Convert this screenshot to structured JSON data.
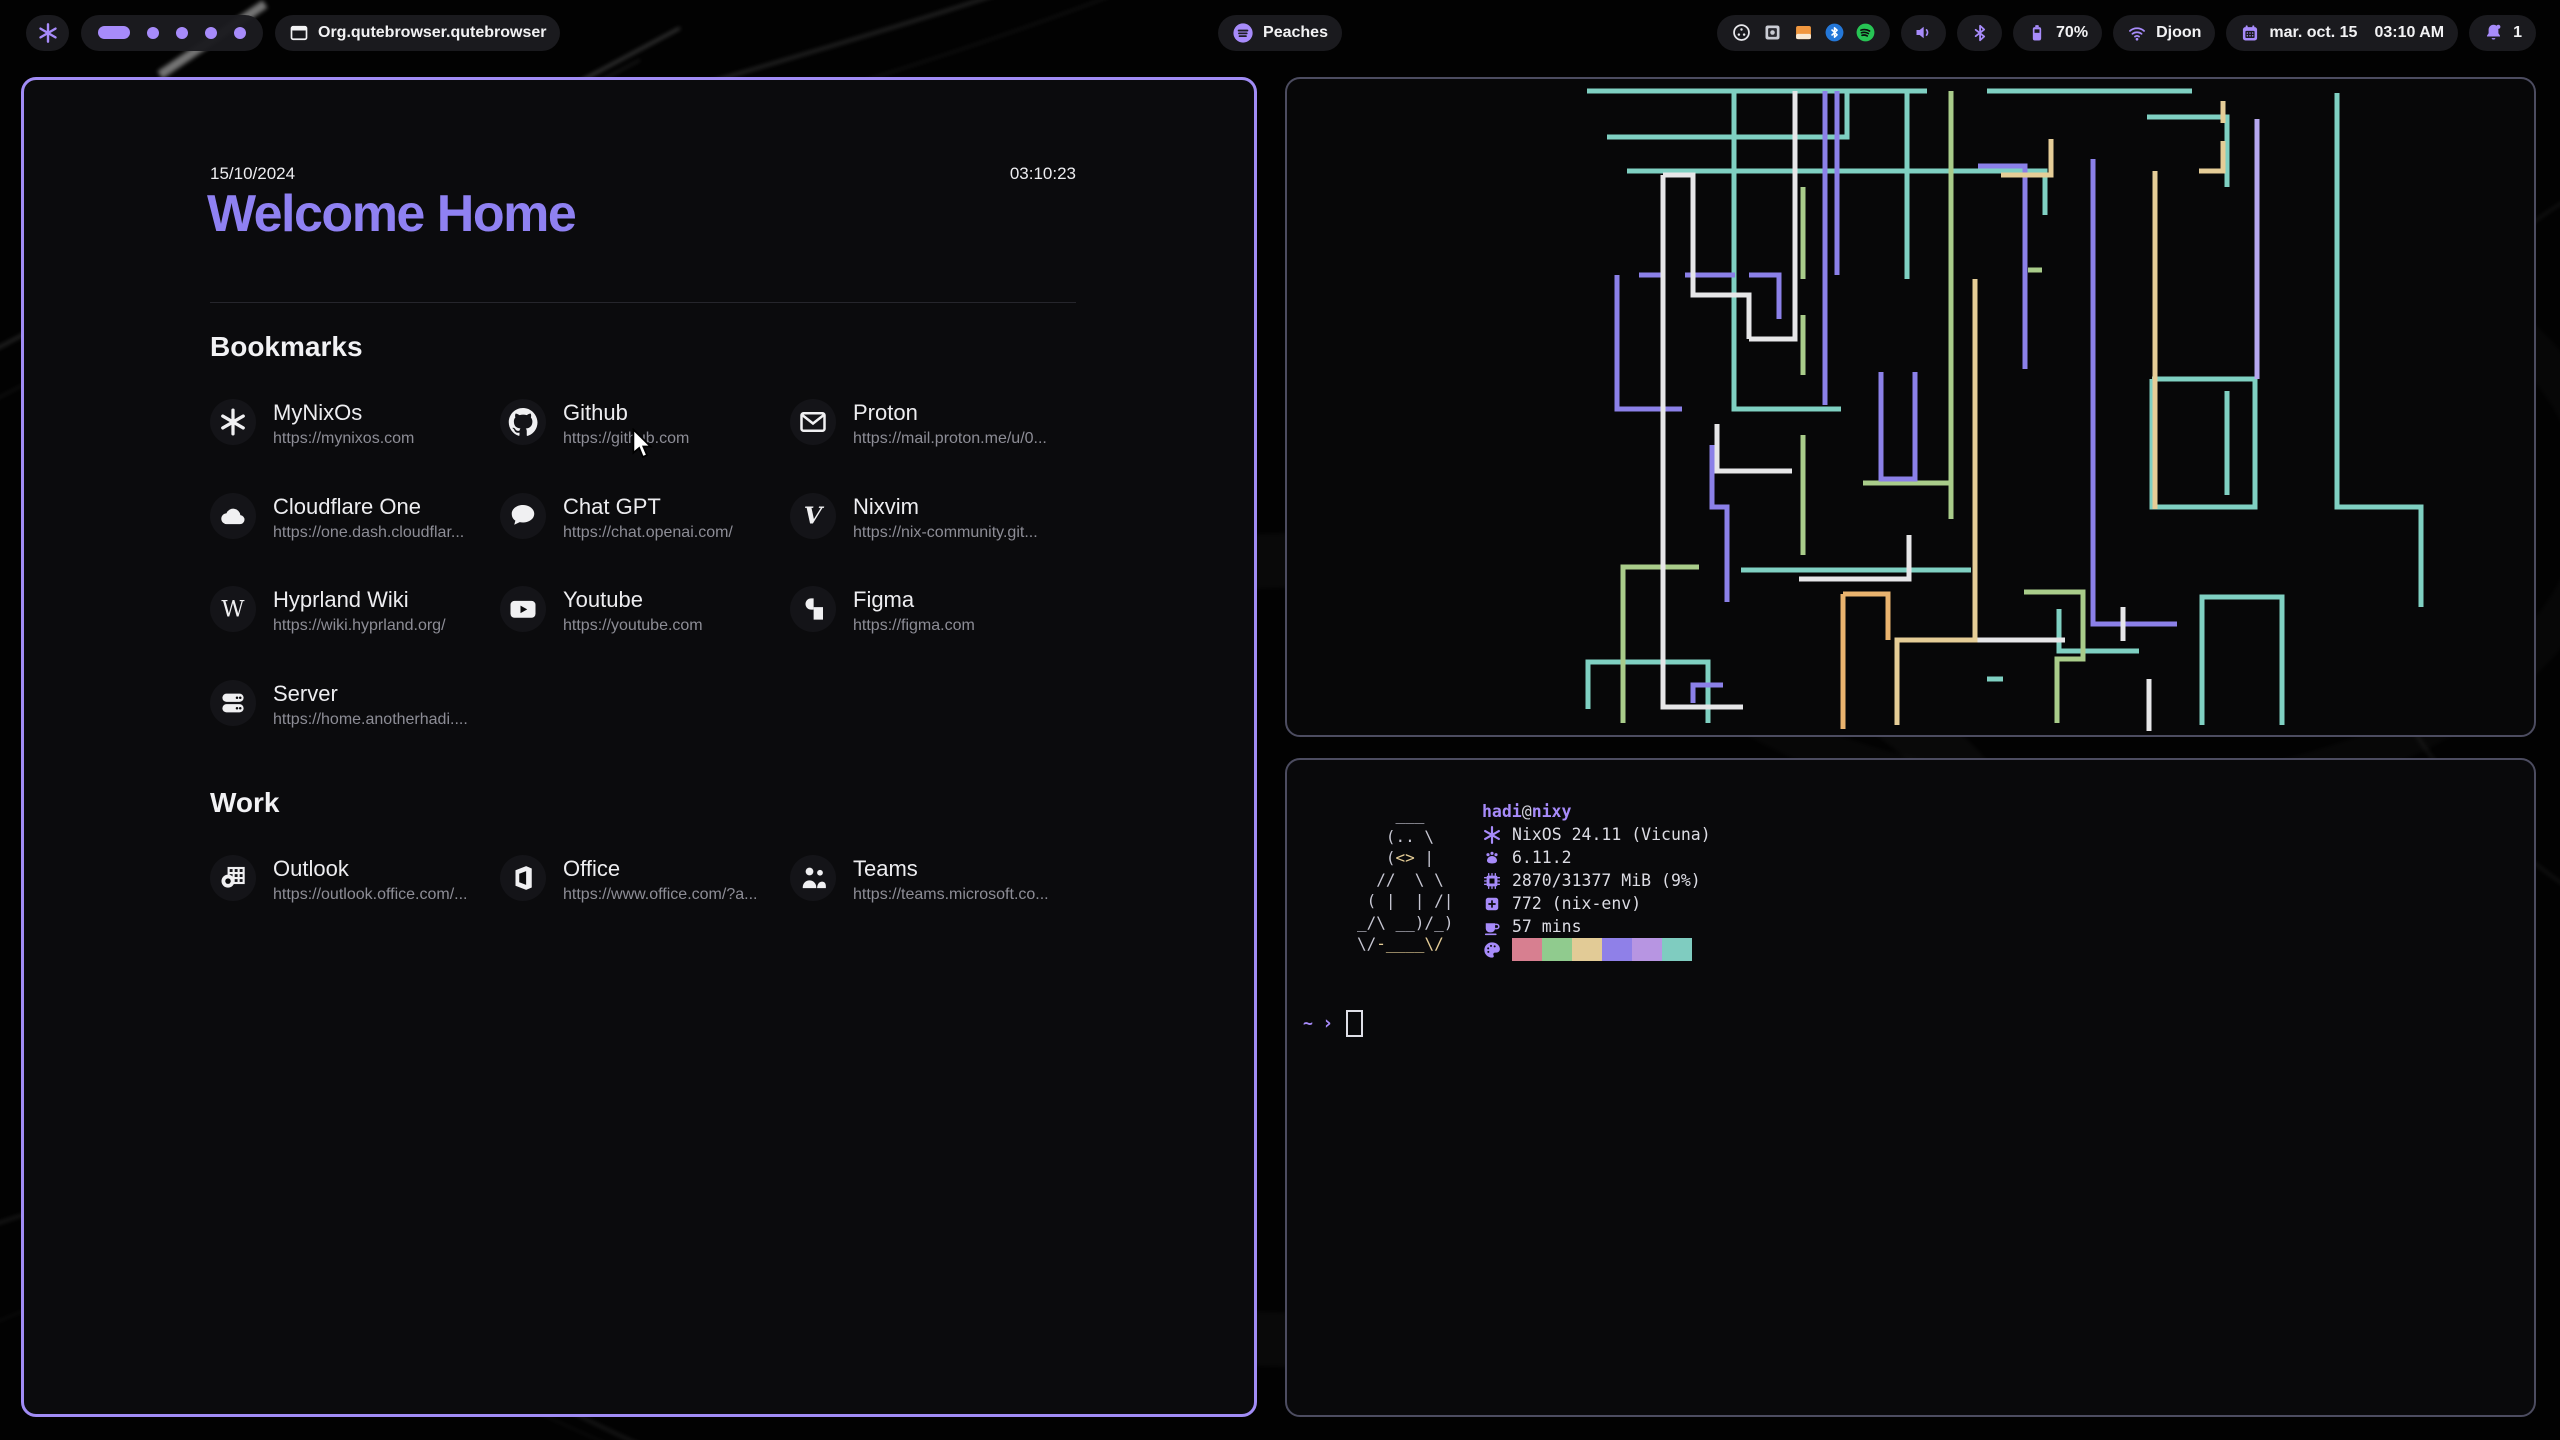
{
  "colors": {
    "accent": "#a78bfa",
    "heading_purple": "#8f81f2",
    "window_border_active": "#a18cf5",
    "window_border_inactive": "#4c4c60",
    "pill_bg": "#1b1b1f",
    "url_gray": "#8d8d96"
  },
  "topbar": {
    "logo_icon": "nix-snowflake-icon",
    "workspaces": {
      "count": 5,
      "active_index": 0
    },
    "window_title": "Org.qutebrowser.qutebrowser",
    "media": {
      "icon": "spotify-icon",
      "label": "Peaches"
    },
    "tray": [
      "screen-recorder",
      "password-vault",
      "file-manager",
      "bluetooth",
      "spotify"
    ],
    "battery": {
      "percent": "70%"
    },
    "network": {
      "ssid": "Djoon"
    },
    "clock": {
      "date": "mar. oct. 15",
      "time": "03:10 AM"
    },
    "notifications": {
      "count": "1"
    }
  },
  "startpage": {
    "date": "15/10/2024",
    "time": "03:10:23",
    "title": "Welcome Home",
    "sections": [
      {
        "heading": "Bookmarks",
        "links": [
          {
            "name": "MyNixOs",
            "url": "https://mynixos.com",
            "icon": "nix"
          },
          {
            "name": "Github",
            "url": "https://github.com",
            "icon": "github"
          },
          {
            "name": "Proton",
            "url": "https://mail.proton.me/u/0...",
            "icon": "mail"
          },
          {
            "name": "Cloudflare One",
            "url": "https://one.dash.cloudflar...",
            "icon": "cloud"
          },
          {
            "name": "Chat GPT",
            "url": "https://chat.openai.com/",
            "icon": "chat"
          },
          {
            "name": "Nixvim",
            "url": "https://nix-community.git...",
            "icon": "vim"
          },
          {
            "name": "Hyprland Wiki",
            "url": "https://wiki.hyprland.org/",
            "icon": "wiki"
          },
          {
            "name": "Youtube",
            "url": "https://youtube.com",
            "icon": "youtube"
          },
          {
            "name": "Figma",
            "url": "https://figma.com",
            "icon": "figma"
          },
          {
            "name": "Server",
            "url": "https://home.anotherhadi....",
            "icon": "server"
          }
        ]
      },
      {
        "heading": "Work",
        "links": [
          {
            "name": "Outlook",
            "url": "https://outlook.office.com/...",
            "icon": "outlook"
          },
          {
            "name": "Office",
            "url": "https://www.office.com/?a...",
            "icon": "office"
          },
          {
            "name": "Teams",
            "url": "https://teams.microsoft.co...",
            "icon": "teams"
          }
        ]
      }
    ]
  },
  "fetch": {
    "user": "hadi",
    "at": "@",
    "host": "nixy",
    "rows": [
      {
        "icon": "os",
        "text": "NixOS 24.11 (Vicuna)"
      },
      {
        "icon": "kernel",
        "text": "6.11.2"
      },
      {
        "icon": "memory",
        "text": "2870/31377 MiB (9%)"
      },
      {
        "icon": "packages",
        "text": "772 (nix-env)"
      },
      {
        "icon": "uptime",
        "text": "57 mins"
      }
    ],
    "palette": [
      "#d77f90",
      "#90cb8e",
      "#e2cb96",
      "#8f80e8",
      "#b795e2",
      "#7fccc0"
    ],
    "ascii": [
      [
        [
          "    ___",
          "f"
        ]
      ],
      [
        [
          "   (.. \\",
          "f"
        ]
      ],
      [
        [
          "   (",
          "f"
        ],
        [
          "<>",
          "y"
        ],
        [
          " |",
          "f"
        ]
      ],
      [
        [
          "  //  \\ \\",
          "f"
        ]
      ],
      [
        [
          " ( |  | /|",
          "f"
        ]
      ],
      [
        [
          "_/\\ __)/_)",
          "f"
        ]
      ],
      [
        [
          "\\/",
          "f"
        ],
        [
          "-____",
          "y"
        ],
        [
          "\\/",
          "y"
        ]
      ]
    ],
    "prompt": {
      "cwd": "~",
      "symbol": "›"
    }
  },
  "pipes": {
    "stroke_width": 5,
    "colors": {
      "t": "#7fd0c2",
      "g": "#a9cc8a",
      "p": "#8b80e8",
      "lp": "#b6a7ef",
      "w": "#e6e6e8",
      "y": "#e5cd97",
      "o": "#eab36e"
    },
    "paths": [
      [
        "t",
        [
          [
            300,
            12
          ],
          [
            640,
            12
          ]
        ]
      ],
      [
        "t",
        [
          [
            700,
            12
          ],
          [
            905,
            12
          ]
        ]
      ],
      [
        "t",
        [
          [
            320,
            58
          ],
          [
            560,
            58
          ],
          [
            560,
            12
          ]
        ]
      ],
      [
        "t",
        [
          [
            340,
            92
          ],
          [
            758,
            92
          ],
          [
            758,
            136
          ]
        ]
      ],
      [
        "t",
        [
          [
            860,
            38
          ],
          [
            940,
            38
          ],
          [
            940,
            108
          ]
        ]
      ],
      [
        "t",
        [
          [
            447,
            12
          ],
          [
            447,
            330
          ],
          [
            554,
            330
          ]
        ]
      ],
      [
        "t",
        [
          [
            620,
            12
          ],
          [
            620,
            200
          ]
        ]
      ],
      [
        "t",
        [
          [
            454,
            491
          ],
          [
            684,
            491
          ]
        ]
      ],
      [
        "t",
        [
          [
            301,
            630
          ],
          [
            301,
            583
          ],
          [
            421,
            583
          ],
          [
            421,
            644
          ]
        ]
      ],
      [
        "t",
        [
          [
            772,
            530
          ],
          [
            772,
            572
          ],
          [
            852,
            572
          ]
        ]
      ],
      [
        "t",
        [
          [
            865,
            300
          ],
          [
            865,
            428
          ],
          [
            968,
            428
          ],
          [
            968,
            300
          ],
          [
            865,
            300
          ]
        ]
      ],
      [
        "t",
        [
          [
            940,
            312
          ],
          [
            940,
            416
          ]
        ]
      ],
      [
        "t",
        [
          [
            1050,
            14
          ],
          [
            1050,
            428
          ],
          [
            1134,
            428
          ],
          [
            1134,
            528
          ]
        ]
      ],
      [
        "t",
        [
          [
            915,
            646
          ],
          [
            915,
            518
          ],
          [
            995,
            518
          ],
          [
            995,
            646
          ]
        ]
      ],
      [
        "t",
        [
          [
            700,
            600
          ],
          [
            716,
            600
          ]
        ]
      ],
      [
        "g",
        [
          [
            516,
            108
          ],
          [
            516,
            200
          ]
        ]
      ],
      [
        "g",
        [
          [
            516,
            236
          ],
          [
            516,
            296
          ]
        ]
      ],
      [
        "g",
        [
          [
            516,
            356
          ],
          [
            516,
            476
          ]
        ]
      ],
      [
        "g",
        [
          [
            664,
            12
          ],
          [
            664,
            440
          ]
        ]
      ],
      [
        "g",
        [
          [
            576,
            404
          ],
          [
            666,
            404
          ]
        ]
      ],
      [
        "g",
        [
          [
            412,
            488
          ],
          [
            336,
            488
          ],
          [
            336,
            644
          ]
        ]
      ],
      [
        "g",
        [
          [
            737,
            513
          ],
          [
            796,
            513
          ],
          [
            796,
            580
          ],
          [
            770,
            580
          ],
          [
            770,
            644
          ]
        ]
      ],
      [
        "g",
        [
          [
            741,
            191
          ],
          [
            755,
            191
          ]
        ]
      ],
      [
        "p",
        [
          [
            330,
            196
          ],
          [
            330,
            330
          ],
          [
            395,
            330
          ]
        ]
      ],
      [
        "p",
        [
          [
            352,
            196
          ],
          [
            376,
            196
          ]
        ]
      ],
      [
        "p",
        [
          [
            398,
            196
          ],
          [
            448,
            196
          ]
        ]
      ],
      [
        "p",
        [
          [
            462,
            196
          ],
          [
            492,
            196
          ],
          [
            492,
            240
          ]
        ]
      ],
      [
        "p",
        [
          [
            538,
            12
          ],
          [
            538,
            326
          ]
        ]
      ],
      [
        "p",
        [
          [
            550,
            12
          ],
          [
            550,
            196
          ]
        ]
      ],
      [
        "p",
        [
          [
            594,
            293
          ],
          [
            594,
            400
          ],
          [
            628,
            400
          ],
          [
            628,
            293
          ]
        ]
      ],
      [
        "p",
        [
          [
            425,
            366
          ],
          [
            425,
            428
          ],
          [
            440,
            428
          ],
          [
            440,
            523
          ]
        ]
      ],
      [
        "p",
        [
          [
            406,
            624
          ],
          [
            406,
            606
          ],
          [
            436,
            606
          ]
        ]
      ],
      [
        "p",
        [
          [
            806,
            80
          ],
          [
            806,
            545
          ],
          [
            890,
            545
          ]
        ]
      ],
      [
        "p",
        [
          [
            691,
            87
          ],
          [
            738,
            87
          ],
          [
            738,
            290
          ]
        ]
      ],
      [
        "lp",
        [
          [
            970,
            40
          ],
          [
            970,
            300
          ]
        ]
      ],
      [
        "w",
        [
          [
            376,
            96
          ],
          [
            376,
            628
          ],
          [
            456,
            628
          ]
        ]
      ],
      [
        "w",
        [
          [
            376,
            96
          ],
          [
            406,
            96
          ],
          [
            406,
            216
          ],
          [
            462,
            216
          ],
          [
            462,
            260
          ]
        ]
      ],
      [
        "w",
        [
          [
            508,
            12
          ],
          [
            508,
            260
          ],
          [
            462,
            260
          ]
        ]
      ],
      [
        "w",
        [
          [
            430,
            345
          ],
          [
            430,
            392
          ],
          [
            505,
            392
          ]
        ]
      ],
      [
        "w",
        [
          [
            512,
            500
          ],
          [
            622,
            500
          ],
          [
            622,
            456
          ]
        ]
      ],
      [
        "w",
        [
          [
            652,
            561
          ],
          [
            778,
            561
          ]
        ]
      ],
      [
        "w",
        [
          [
            836,
            562
          ],
          [
            836,
            528
          ]
        ]
      ],
      [
        "w",
        [
          [
            862,
            600
          ],
          [
            862,
            652
          ]
        ]
      ],
      [
        "y",
        [
          [
            936,
            22
          ],
          [
            936,
            44
          ]
        ]
      ],
      [
        "y",
        [
          [
            936,
            62
          ],
          [
            936,
            92
          ],
          [
            912,
            92
          ]
        ]
      ],
      [
        "y",
        [
          [
            868,
            92
          ],
          [
            868,
            430
          ]
        ]
      ],
      [
        "y",
        [
          [
            688,
            200
          ],
          [
            688,
            561
          ],
          [
            610,
            561
          ],
          [
            610,
            646
          ]
        ]
      ],
      [
        "y",
        [
          [
            714,
            96
          ],
          [
            764,
            96
          ],
          [
            764,
            60
          ]
        ]
      ],
      [
        "o",
        [
          [
            556,
            515
          ],
          [
            601,
            515
          ],
          [
            601,
            561
          ]
        ]
      ],
      [
        "o",
        [
          [
            556,
            515
          ],
          [
            556,
            650
          ]
        ]
      ]
    ]
  }
}
